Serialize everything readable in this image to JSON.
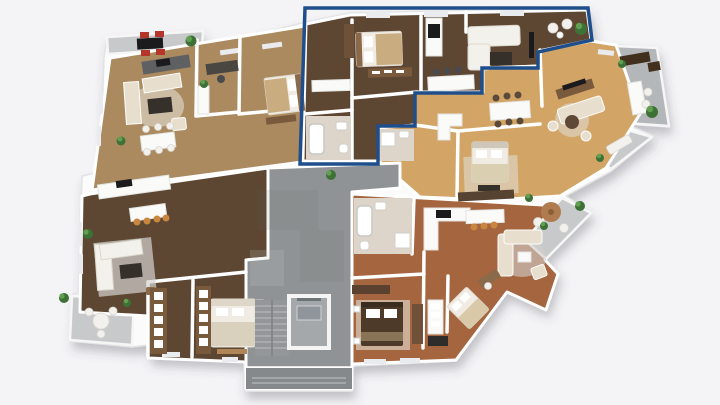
{
  "scene": {
    "type": "3d-floor-plan-render",
    "view": "isometric top-down dollhouse view",
    "background": "#f4f4f6",
    "storey": "residential floor with five apartments around a central stair-and-elevator core"
  },
  "highlight": {
    "outline_color": "#1f4e8c",
    "outline_width": 3.5,
    "target": "top-center apartment"
  },
  "palette": {
    "building_base": "#fbfbfc",
    "building_edge": "#e2e3e5",
    "wall": "#ffffff",
    "floor_tan": "#ab8a60",
    "floor_walnut": "#5d4733",
    "floor_oak": "#d2a566",
    "floor_terracotta": "#a5653f",
    "tile": "#ddd5c9",
    "concrete": "#909395",
    "concrete_dark": "#86898c",
    "balcony": "#c7c9cb",
    "balcony_dark": "#b4b7b9",
    "sofa_beige": "#e7decd",
    "sofa_white": "#f3f1ec",
    "wood_dark": "#4e3a28",
    "wood_mid": "#7a5a3d",
    "counter": "#fafaf9",
    "appliance_black": "#1e1e1e",
    "chair_red": "#b5352a",
    "stool_orange": "#c8863f",
    "plant_green": "#477a3c",
    "rug": "#ded7ca"
  },
  "units": [
    {
      "id": "unit-top-left",
      "floor": "tan wood",
      "highlighted": false,
      "features": [
        "balcony with outdoor dining and red chairs",
        "kitchen corner",
        "living room with beige sofas",
        "dining table for six",
        "home office desk",
        "bedroom with double bed"
      ]
    },
    {
      "id": "unit-bottom-left",
      "floor": "dark walnut wood",
      "highlighted": false,
      "features": [
        "kitchen with island and four stools",
        "corner sofa on rug",
        "bedroom with double bed",
        "two walk-in wardrobes",
        "balcony with round table"
      ]
    },
    {
      "id": "unit-top-center",
      "floor": "dark walnut wood",
      "highlighted": true,
      "features": [
        "bedroom with dresser",
        "kitchen island with stools",
        "living room with corner sofa and TV",
        "corner balcony with plants",
        "bathroom with tub"
      ]
    },
    {
      "id": "unit-top-right",
      "floor": "light oak wood",
      "highlighted": false,
      "features": [
        "dining table for six",
        "lounge with TV sideboard",
        "bedroom with double bed",
        "large furnished balcony",
        "small bench balcony"
      ]
    },
    {
      "id": "unit-bottom-right",
      "floor": "terracotta wood",
      "highlighted": false,
      "features": [
        "two bathrooms",
        "kitchen with island",
        "living room with beige sofa",
        "dark-wood bedroom",
        "second bedroom",
        "balcony with round wooden table"
      ]
    }
  ],
  "core": {
    "id": "stair-core",
    "floor": "concrete",
    "features": [
      "staircase",
      "elevator shaft",
      "entrance porch"
    ]
  }
}
